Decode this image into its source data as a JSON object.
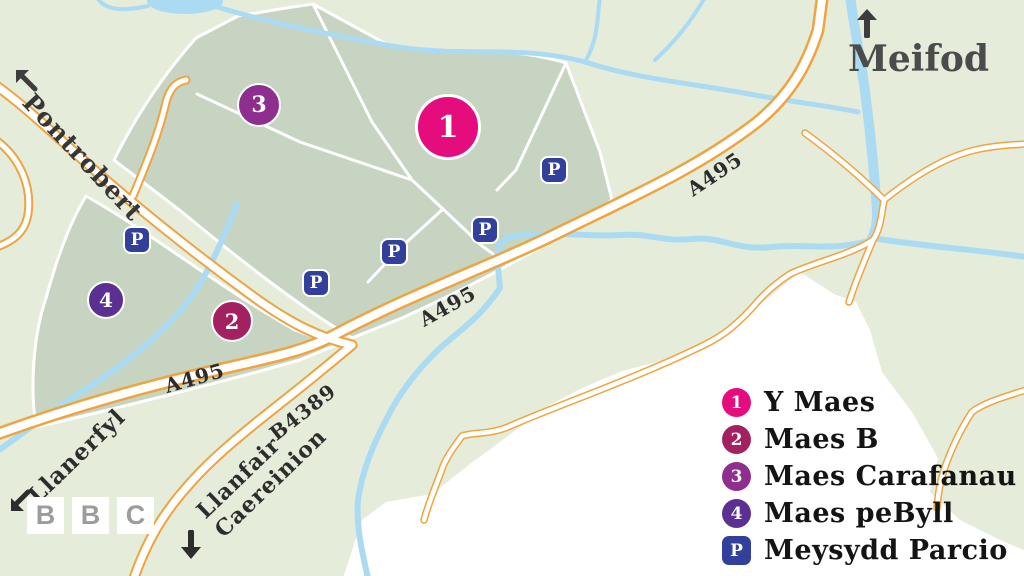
{
  "site": {
    "venues": [
      {
        "number": "1",
        "name": "Y Maes",
        "color": "#e50c7e"
      },
      {
        "number": "2",
        "name": "Maes B",
        "color": "#a32061"
      },
      {
        "number": "3",
        "name": "Maes Carafanau",
        "color": "#8e2e8e"
      },
      {
        "number": "4",
        "name": "Maes peByll",
        "color": "#5b3092"
      }
    ],
    "parking": {
      "symbol": "P",
      "label": "Meysydd Parcio",
      "color": "#32409b",
      "map_marker_count": 5
    }
  },
  "roads": {
    "a495": "A495",
    "b4389": "B4389"
  },
  "destinations": {
    "pontrobert": {
      "name": "Pontrobert",
      "direction": "up-left"
    },
    "meifod": {
      "name": "Meifod",
      "direction": "up"
    },
    "llanerfyl": {
      "name": "Llanerfyl",
      "direction": "down-left"
    },
    "llanfair": {
      "name": "Llanfair Caereinion",
      "line1": "Llanfair",
      "line2": "Caereinion",
      "direction": "down"
    }
  },
  "branding": {
    "letter1": "B",
    "letter2": "B",
    "letter3": "C"
  },
  "colors": {
    "background": "#e5ecd9",
    "field": "#c7d4c2",
    "river": "#abdbf2",
    "road_casing": "#efa440",
    "road_fill": "#ffffff",
    "unmapped": "#ffffff",
    "label_dark": "#2c2c2c",
    "place_dark": "#363636",
    "meifod_grey": "#4b4b4b",
    "bbc_letter_grey": "#9c9c9c"
  }
}
